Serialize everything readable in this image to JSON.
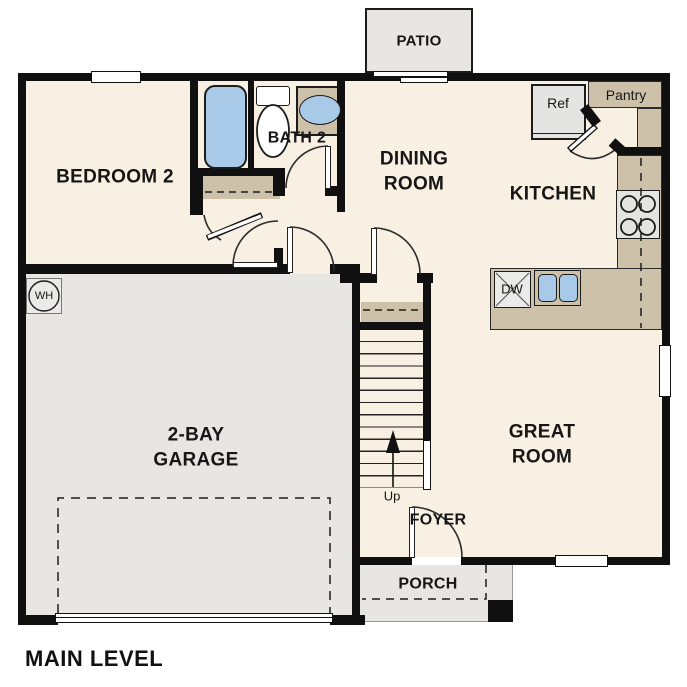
{
  "plan_title": "MAIN LEVEL",
  "labels": {
    "patio": "PATIO",
    "bedroom2": "BEDROOM 2",
    "bath2": "BATH 2",
    "dining_line1": "DINING",
    "dining_line2": "ROOM",
    "kitchen": "KITCHEN",
    "pantry": "Pantry",
    "ref": "Ref",
    "great_line1": "GREAT",
    "great_line2": "ROOM",
    "garage_line1": "2-BAY",
    "garage_line2": "GARAGE",
    "foyer": "FOYER",
    "porch": "PORCH",
    "up": "Up",
    "wh": "WH",
    "dw": "DW"
  },
  "colors": {
    "floor": "#f8f0e3",
    "wall": "#101010",
    "exterior_area": "#e7e6e3",
    "counter_tan": "#cdc1a9",
    "fixture_blue": "#a9c9e9",
    "appliance_gray": "#e4e4e2",
    "background": "#ffffff"
  }
}
